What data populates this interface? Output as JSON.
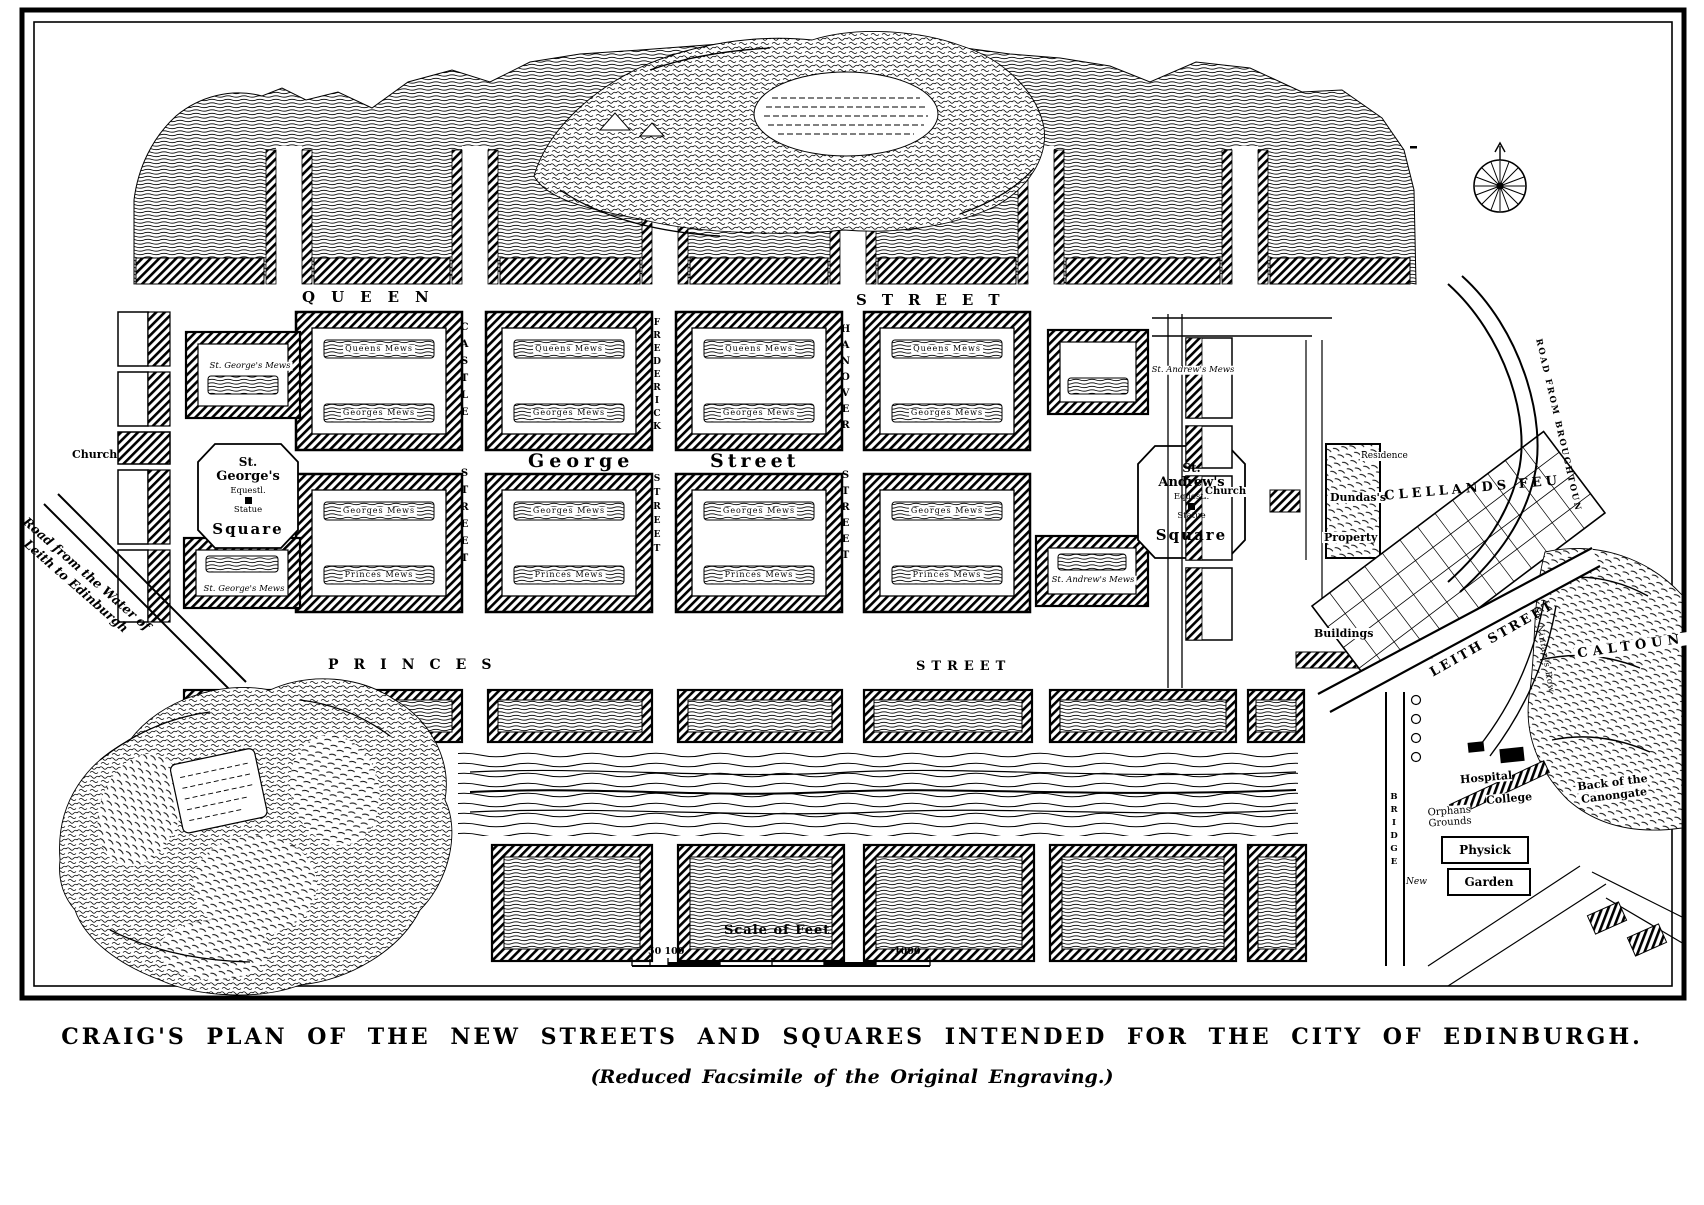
{
  "colors": {
    "ink": "#000000",
    "paper": "#ffffff"
  },
  "caption": {
    "title": "CRAIG'S PLAN OF THE NEW STREETS AND SQUARES INTENDED FOR THE CITY OF EDINBURGH.",
    "subtitle": "(Reduced Facsimile of the Original Engraving.)"
  },
  "streets": {
    "queen_w1": "QUEEN",
    "queen_w2": "STREET",
    "george_w1": "George",
    "george_w2": "Street",
    "princes_w1": "PRINCES",
    "princes_w2": "STREET",
    "leith": "LEITH STREET",
    "road_west_l1": "Road from the Water of",
    "road_west_l2": "Leith to Edinburgh",
    "road_broughton": "ROAD FROM BROUGHTOUN",
    "ninians_row": "St. Ninian's Row",
    "bridge": "BRIDGE",
    "bridge_new": "New"
  },
  "cross_streets": [
    {
      "w1": "CASTLE",
      "w2": "STREET"
    },
    {
      "w1": "FREDERICK",
      "w2": "STREET"
    },
    {
      "w1": "HANOVER",
      "w2": "STREET"
    }
  ],
  "squares": {
    "george": {
      "l1": "St.",
      "l2": "George's",
      "l3": "Equestl.",
      "l4": "Statue",
      "l5": "Square"
    },
    "andrew": {
      "l1": "St.",
      "l2": "Andrew's",
      "l3": "Equestl.",
      "l4": "Statue",
      "l5": "Square"
    }
  },
  "churches": {
    "west": "Church",
    "east": "Church"
  },
  "mews_named": {
    "george_n": "St. George's Mews",
    "george_s": "St. George's Mews",
    "andrew_n": "St. Andrew's Mews",
    "andrew_s": "St. Andrew's Mews"
  },
  "mews_labels": [
    {
      "t": "Queens Mews",
      "x": 379,
      "y": 349
    },
    {
      "t": "Queens Mews",
      "x": 569,
      "y": 349
    },
    {
      "t": "Queens Mews",
      "x": 759,
      "y": 349
    },
    {
      "t": "Queens Mews",
      "x": 947,
      "y": 349
    },
    {
      "t": "Georges Mews",
      "x": 379,
      "y": 413
    },
    {
      "t": "Georges Mews",
      "x": 569,
      "y": 413
    },
    {
      "t": "Georges Mews",
      "x": 759,
      "y": 413
    },
    {
      "t": "Georges Mews",
      "x": 947,
      "y": 413
    },
    {
      "t": "Georges Mews",
      "x": 379,
      "y": 511
    },
    {
      "t": "Georges Mews",
      "x": 569,
      "y": 511
    },
    {
      "t": "Georges Mews",
      "x": 759,
      "y": 511
    },
    {
      "t": "Georges Mews",
      "x": 947,
      "y": 511
    },
    {
      "t": "Princes Mews",
      "x": 379,
      "y": 575
    },
    {
      "t": "Princes Mews",
      "x": 569,
      "y": 575
    },
    {
      "t": "Princes Mews",
      "x": 759,
      "y": 575
    },
    {
      "t": "Princes Mews",
      "x": 947,
      "y": 575
    }
  ],
  "east_area": {
    "residence": "Residence",
    "dundas": "Dundas's",
    "property": "Property",
    "clellands": "CLELLANDS FEU",
    "caltoun": "CALTOUN",
    "canongate_l1": "Back of the",
    "canongate_l2": "Canongate",
    "hospital": "Hospital",
    "college": "College",
    "orphans_l1": "Orphans",
    "orphans_l2": "Grounds",
    "physick": "Physick",
    "garden": "Garden",
    "buildings": "Buildings"
  },
  "scale_bar": {
    "title": "Scale of Feet",
    "left_labels": "50 100",
    "right_label": "1000"
  }
}
